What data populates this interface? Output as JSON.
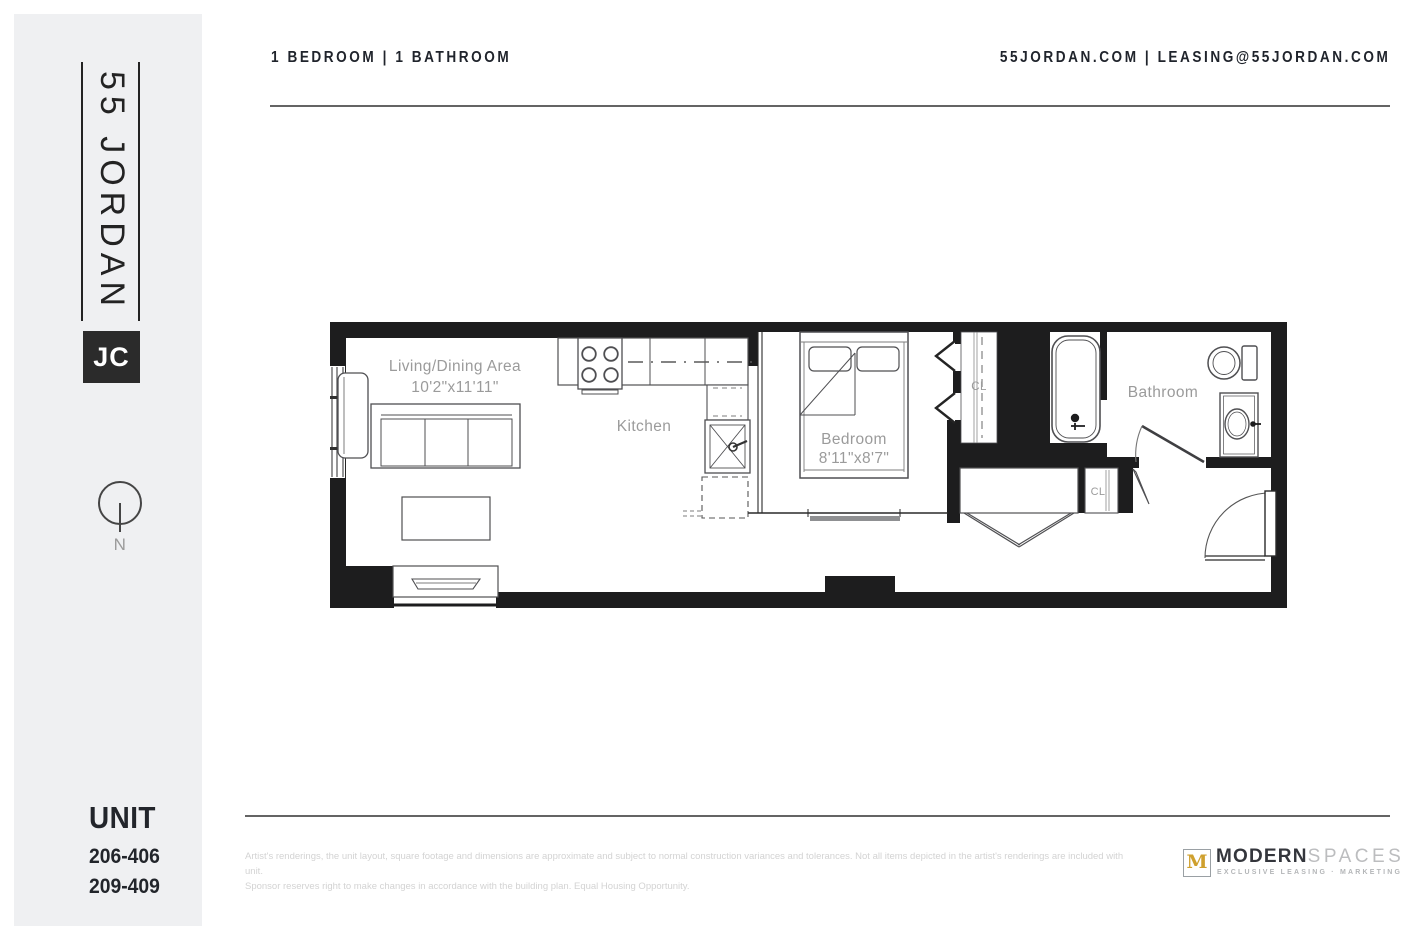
{
  "sidebar": {
    "logo_text": "55 JORDAN",
    "logo_badge": "JC",
    "compass_n": "N",
    "unit_heading": "UNIT",
    "unit_numbers": [
      "206-406",
      "209-409"
    ]
  },
  "header": {
    "left_text": "1 BEDROOM | 1 BATHROOM",
    "right_text": "55JORDAN.COM | LEASING@55JORDAN.COM"
  },
  "floorplan": {
    "labels": {
      "living_name": "Living/Dining Area",
      "living_dims": "10'2\"x11'11\"",
      "kitchen": "Kitchen",
      "bedroom_name": "Bedroom",
      "bedroom_dims": "8'11\"x8'7\"",
      "bathroom": "Bathroom",
      "closet_1": "CL",
      "closet_2": "CL"
    },
    "colors": {
      "wall": "#1d1d1e",
      "furniture_line": "#4f4f52",
      "label": "#9b9b9b"
    }
  },
  "footer": {
    "disclaimer_line1": "Artist's renderings, the unit layout, square footage and dimensions are approximate and subject to normal construction variances and tolerances. Not all items depicted in the artist's renderings are included with unit.",
    "disclaimer_line2": "Sponsor reserves right to make changes in accordance with the building plan. Equal Housing Opportunity.",
    "brand": {
      "monogram": "M",
      "name_bold": "MODERN",
      "name_light": "SPACES",
      "tagline": "EXCLUSIVE LEASING · MARKETING",
      "gold": "#cfa02e"
    }
  }
}
